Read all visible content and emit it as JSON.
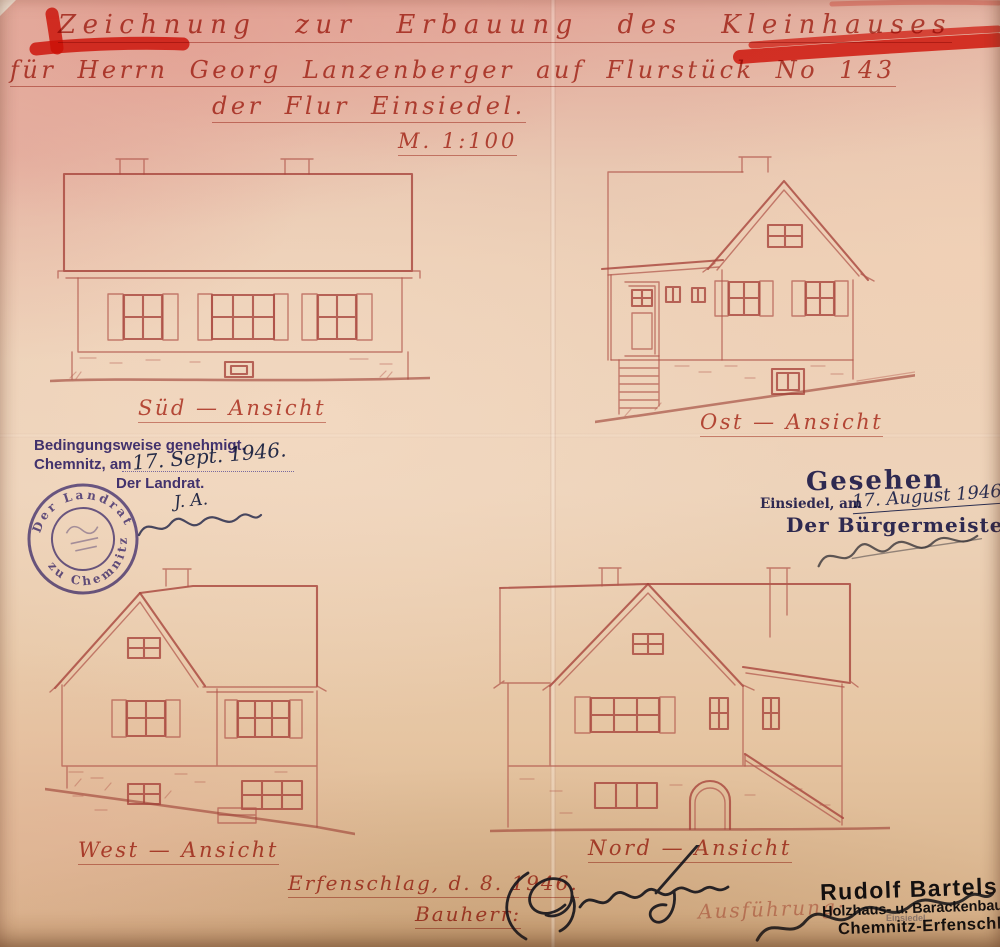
{
  "document": {
    "title_line1": "Zeichnung zur Erbauung des Kleinhauses",
    "title_line2": "für Herrn Georg Lanzenberger auf Flurstück No 143",
    "title_line3": "der Flur Einsiedel.",
    "scale": "M. 1:100"
  },
  "views": {
    "south_label": "Süd — Ansicht",
    "east_label": "Ost — Ansicht",
    "west_label": "West — Ansicht",
    "north_label": "Nord — Ansicht"
  },
  "approval_stamp": {
    "line1": "Bedingungsweise genehmigt.",
    "place_prefix": "Chemnitz, am",
    "date_handwritten": "17. Sept. 1946.",
    "authority": "Der Landrat.",
    "initials": "J. A.",
    "seal_top": "Der Landrat",
    "seal_bottom": "zu Chemnitz"
  },
  "seen_stamp": {
    "title": "Gesehen",
    "place_prefix": "Einsiedel, am",
    "date_handwritten": "17. August 1946",
    "authority": "Der Bürgermeister"
  },
  "footer": {
    "place_date": "Erfenschlag, d. 8. 1946.",
    "client_label": "Bauherr:",
    "contractor_label": "Ausführung:"
  },
  "builder_stamp": {
    "name": "Rudolf Bartels",
    "trade": "Holzhaus- u. Barackenbau",
    "overprint": "Einsiedel",
    "city": "Chemnitz-Erfenschlag"
  },
  "colors": {
    "drawing_ink": "#b2584c",
    "script_ink": "#bb463a",
    "crayon_red": "#e5190b",
    "stamp_violet": "#463b92",
    "stamp_indigo": "#31316f",
    "signature_black": "#14141b",
    "paper_base": "#edd3ba"
  }
}
